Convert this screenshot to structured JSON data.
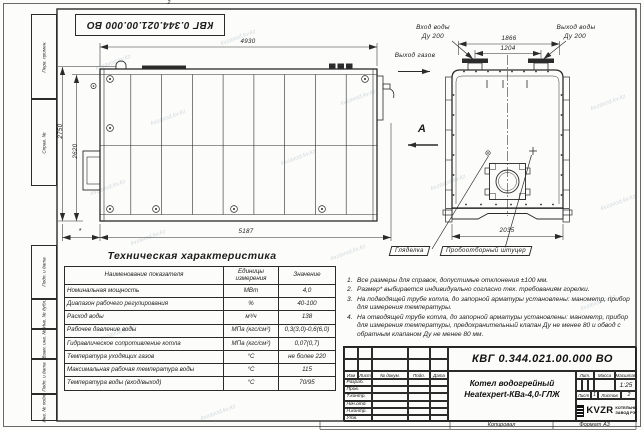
{
  "page": {
    "zone_marker": "2",
    "copied_label": "Копировал",
    "format_label": "Формат А3",
    "watermark": "kvzavod.kv.kz"
  },
  "stamp_top": "КВГ 0.344.021.00.000 ВО",
  "margin_labels": [
    "Перв. примен.",
    "Справ. №",
    "Подп. и дата",
    "Инв. № дубл.",
    "Взам. инв. №",
    "Подп. и дата",
    "Инв. № подл."
  ],
  "front_view": {
    "dim_top": "4930",
    "dim_left_outer": "2750",
    "dim_left_inner": "2620",
    "dim_bottom": "5187",
    "dim_star": "*",
    "label_gas_out": "Выход газов",
    "view_letter": "А"
  },
  "end_view": {
    "dim_top_outer": "1866",
    "dim_top_inner": "1204",
    "dim_bottom": "2035",
    "inlet_line1": "Вход воды",
    "inlet_line2": "Ду 200",
    "outlet_line1": "Выход воды",
    "outlet_line2": "Ду 200",
    "label_sight_glass": "Гляделка",
    "label_sampling": "Пробоотборный штуцер"
  },
  "tech_table": {
    "title": "Техническая характеристика",
    "headers": [
      "Наименование показателя",
      "Единицы измерения",
      "Значение"
    ],
    "rows": [
      [
        "Номинальная мощность",
        "МВт",
        "4,0"
      ],
      [
        "Диапазон рабочего регулирования",
        "%",
        "40-100"
      ],
      [
        "Расход воды",
        "м³/ч",
        "138"
      ],
      [
        "Рабочее давление воды",
        "МПа (кгс/см²)",
        "0,3(3,0)-0,6(6,0)"
      ],
      [
        "Гидравлическое сопротивление котла",
        "МПа (кгс/см²)",
        "0,07(0,7)"
      ],
      [
        "Температура уходящих газов",
        "°С",
        "не более 220"
      ],
      [
        "Максимальная рабочая температура воды",
        "°С",
        "115"
      ],
      [
        "Температура воды (вход/выход)",
        "°С",
        "70/95"
      ]
    ]
  },
  "notes": [
    {
      "n": "1.",
      "text": "Все размеры для справок, допустимые отклонения ±100 мм."
    },
    {
      "n": "2.",
      "text": "Размер* выбирается индивидуально согласно тех. требованиям горелки."
    },
    {
      "n": "3.",
      "text": "На подводящей трубе котла, до запорной арматуры установлены: манометр, прибор для измерения температуры."
    },
    {
      "n": "4.",
      "text": "На отводящей трубе котла, до запорной арматуры установлены: манометр, прибор для измерения температуры, предохранительный клапан Ду не менее 80 и обвод с обратным клапаном Ду не менее 80 мм."
    }
  ],
  "title_block": {
    "doc_number": "КВГ 0.344.021.00.000 ВО",
    "product_line1": "Котел водогрейный",
    "product_line2": "Heatexpert-КВа-4,0-ГЛЖ",
    "col_izm": "Изм",
    "col_list": "Лист",
    "col_doc": "№ докум.",
    "col_podp": "Подп.",
    "col_data": "Дата",
    "rows": [
      "Разраб.",
      "Пров.",
      "Т.контр.",
      "Нач.отд.",
      "Н.контр.",
      "Утв."
    ],
    "lit": "Лит.",
    "mass": "Масса",
    "scale": "Масштаб",
    "scale_value": "1:25",
    "sheet": "Лист",
    "sheet_value": "1",
    "sheets": "Листов",
    "sheets_value": "2",
    "logo": "KVZR",
    "logo_line1": "КОТЕЛЬНЫЙ",
    "logo_line2": "ЗАВОД РЭП"
  }
}
